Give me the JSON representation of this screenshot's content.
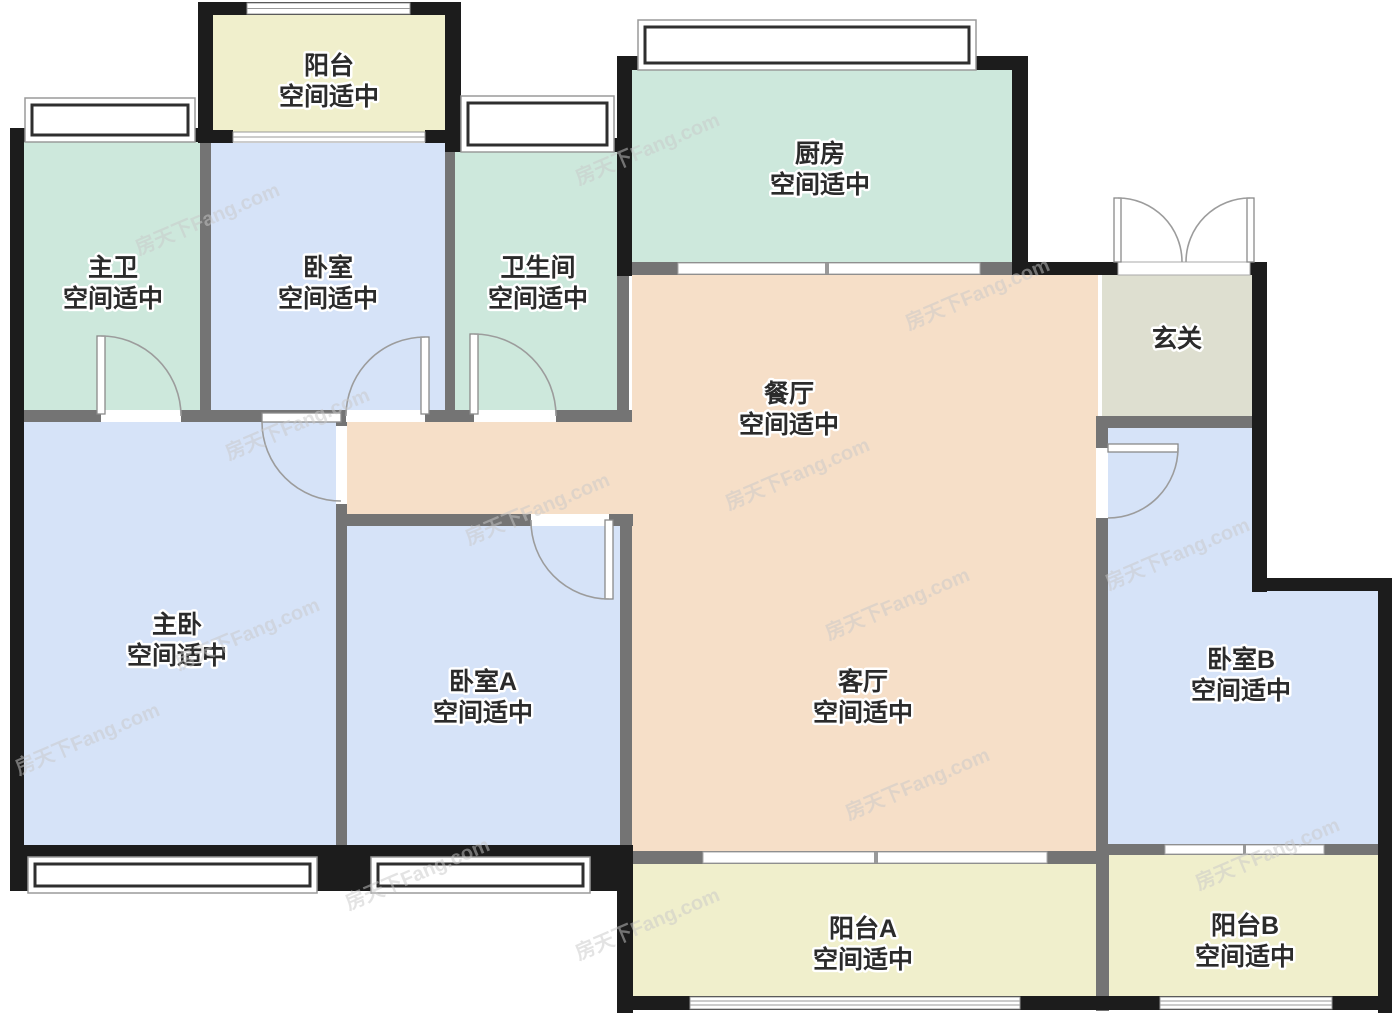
{
  "plan": {
    "watermark": "房天下Fang.com",
    "colors": {
      "wall": "#1c1c1c",
      "partition": "#747474",
      "teal": "#cde8dc",
      "blue": "#d6e3f8",
      "peach": "#f6dfc8",
      "yellow": "#f0efcc",
      "foyer": "#dedfd0",
      "label": "#2b2b2b",
      "door_arc": "#9c9c9c",
      "watermark_color": "#c9c9c9"
    },
    "rooms": {
      "balcony_top": {
        "name": "阳台",
        "status": "空间适中"
      },
      "master_bath": {
        "name": "主卫",
        "status": "空间适中"
      },
      "bedroom_top": {
        "name": "卧室",
        "status": "空间适中"
      },
      "bathroom": {
        "name": "卫生间",
        "status": "空间适中"
      },
      "kitchen": {
        "name": "厨房",
        "status": "空间适中"
      },
      "foyer": {
        "name": "玄关"
      },
      "dining": {
        "name": "餐厅",
        "status": "空间适中"
      },
      "master_bedroom": {
        "name": "主卧",
        "status": "空间适中"
      },
      "bedroom_a": {
        "name": "卧室A",
        "status": "空间适中"
      },
      "living": {
        "name": "客厅",
        "status": "空间适中"
      },
      "bedroom_b": {
        "name": "卧室B",
        "status": "空间适中"
      },
      "balcony_a": {
        "name": "阳台A",
        "status": "空间适中"
      },
      "balcony_b": {
        "name": "阳台B",
        "status": "空间适中"
      }
    }
  }
}
